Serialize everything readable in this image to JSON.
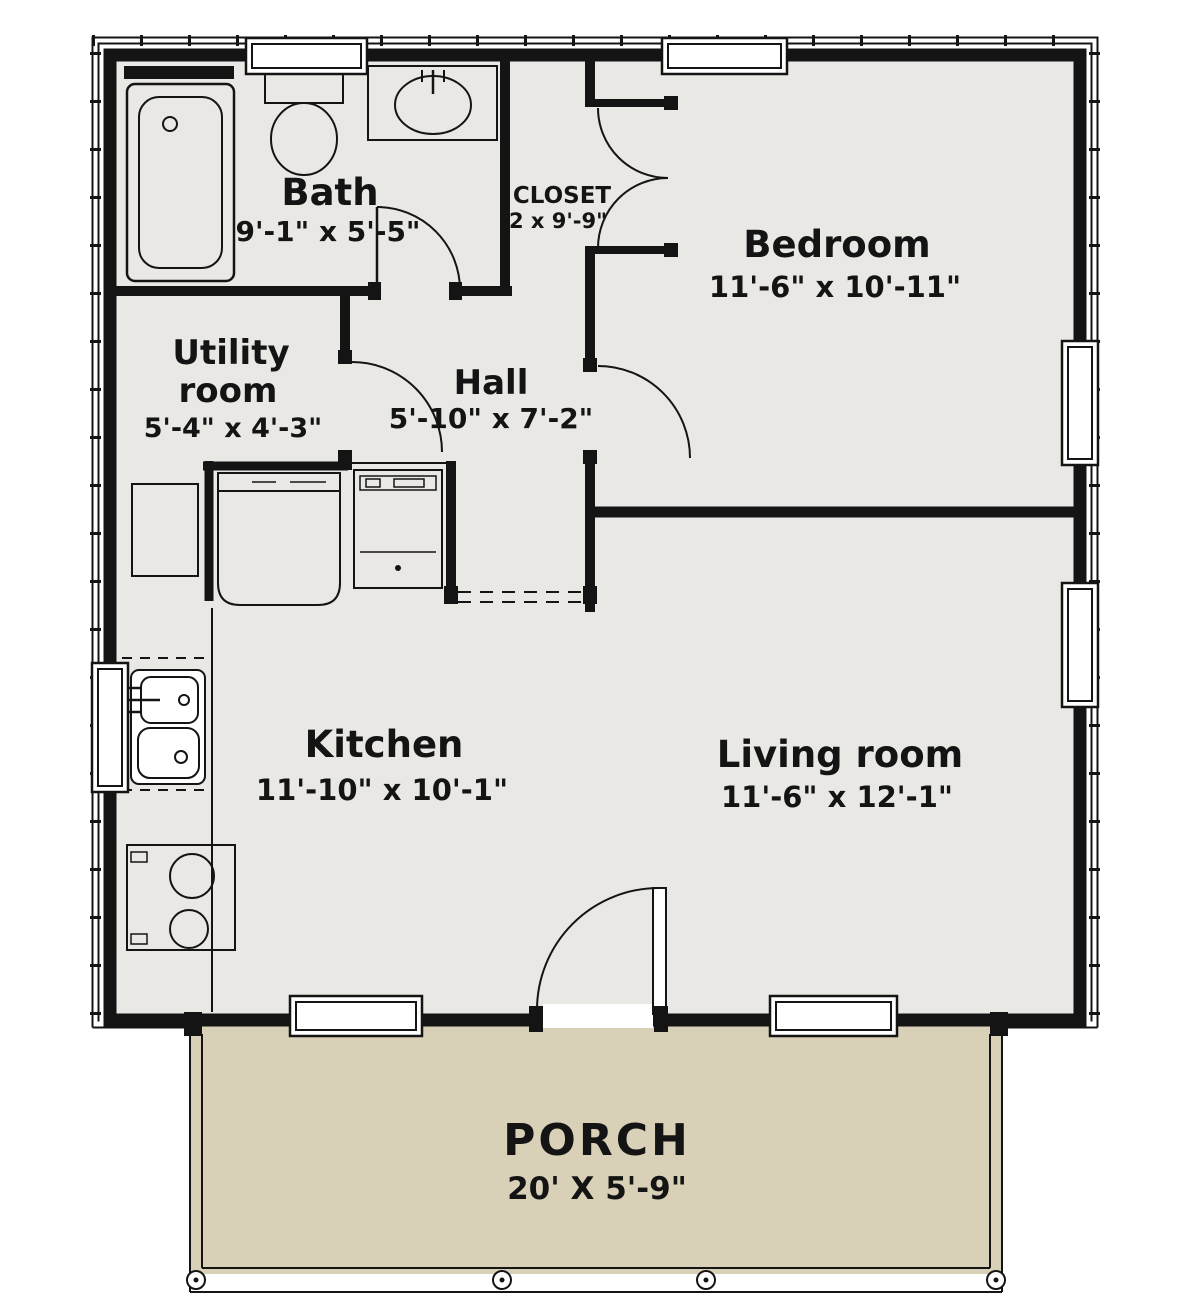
{
  "plan": {
    "rooms": {
      "bath": {
        "name": "Bath",
        "dims": "9'-1\" x 5'-5\""
      },
      "closet": {
        "name": "CLOSET",
        "dims": "2 x 9'-9\""
      },
      "bedroom": {
        "name": "Bedroom",
        "dims": "11'-6\" x 10'-11\""
      },
      "utility": {
        "line1": "Utility",
        "line2": "room",
        "dims": "5'-4\" x 4'-3\""
      },
      "hall": {
        "name": "Hall",
        "dims": "5'-10\" x 7'-2\""
      },
      "kitchen": {
        "name": "Kitchen",
        "dims": "11'-10\" x 10'-1\""
      },
      "living": {
        "name": "Living room",
        "dims": "11'-6\" x 12'-1\""
      },
      "porch": {
        "name": "PORCH",
        "dims": "20' X 5'-9\""
      }
    },
    "colors": {
      "floor": "#e9e8e5",
      "porch": "#d8d0b7",
      "line": "#141414",
      "background": "#ffffff"
    },
    "fixtures": [
      "bathtub",
      "toilet",
      "vanity-sink",
      "closet-double-doors",
      "water-heater",
      "refrigerator",
      "dishwasher",
      "kitchen-sink",
      "range",
      "porch-posts"
    ]
  }
}
